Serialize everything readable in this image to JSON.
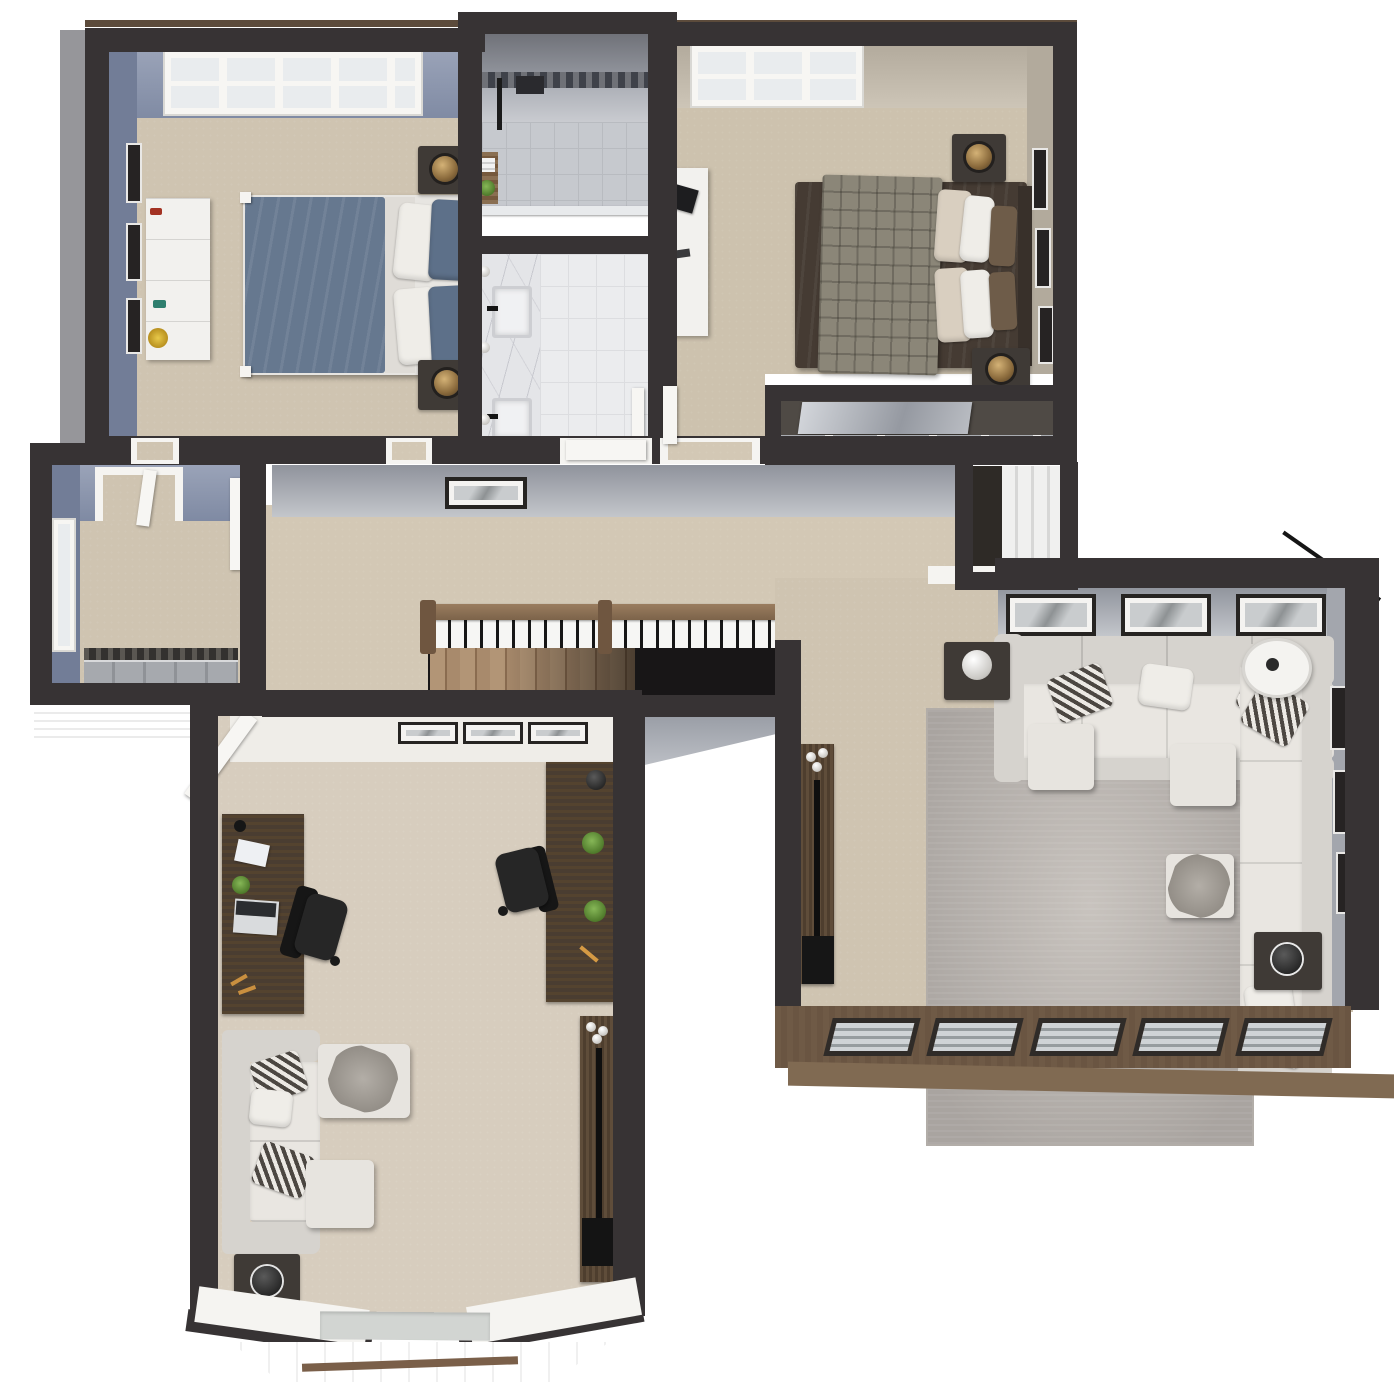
{
  "image_type": "3d-rendered-floor-plan-top-view",
  "visible_text": [],
  "palette": {
    "bg": "#ffffff",
    "wall": "#373334",
    "wall-outer-gray": "#96969a",
    "carpet": "#cfc4b1",
    "carpet-light": "#d7cdbe",
    "carpet-hall": "#d3c8b5",
    "blue-wall": "#8b95ac",
    "greige-wall": "#c1b8ab",
    "white-trim": "#f5f4f1",
    "duvet-blue": "#66788f",
    "bed2-brown": "#453b33",
    "sofa-gray": "#e7e4df",
    "rug-gray": "#bcb7b2",
    "desk-wood": "#4a3d31",
    "table-dark": "#3f3a36",
    "plant-green": "#4f7a2b",
    "ext-brown": "#6a5542",
    "void": "#181617",
    "wood-rail": "#8b7056",
    "tile-floor": "#ebecee"
  },
  "scene": {
    "floor_label": "upper-floor-plan",
    "rooms": [
      {
        "id": "bedroom-1",
        "position": "top-left",
        "wall_finish": "blue-gray",
        "furniture": [
          "tri-pane-window",
          "white-dresser-with-decor",
          "three-wall-frames",
          "queen-bed-blue-duvet-white-sheets",
          "two-nightstands-with-gold-lamps",
          "two-door-openings"
        ]
      },
      {
        "id": "bathroom",
        "position": "top-center",
        "wall_finish": "gray-tile",
        "furniture": [
          "walk-in-shower-mosaic-band",
          "black-shower-fixture",
          "wood-shelf-with-plant-and-towels",
          "marble-double-sink-vanity",
          "chrome-sconces",
          "tile-floor",
          "open-white-door",
          "towel-hooks"
        ]
      },
      {
        "id": "bedroom-2",
        "position": "top-right",
        "wall_finish": "greige",
        "furniture": [
          "tri-pane-window",
          "white-desk-with-laptop",
          "queen-bed-brown-duvet-plaid-throw",
          "cream-and-white-pillows",
          "two-nightstands-with-gold-lamps",
          "three-wall-frames",
          "sliding-mirror-closet",
          "open-white-door"
        ]
      },
      {
        "id": "walk-in-closet",
        "position": "mid-left",
        "wall_finish": "blue-gray",
        "furniture": [
          "side-window",
          "sliding-door-closet-with-clothes",
          "open-white-door"
        ]
      },
      {
        "id": "hallway",
        "position": "center",
        "wall_finish": "gray",
        "furniture": [
          "wall-art-frame",
          "wood-stair-railing-black-balusters",
          "staircase-going-down",
          "attic-stair-nook",
          "three-door-openings"
        ]
      },
      {
        "id": "living-room",
        "position": "right",
        "wall_finish": "gray",
        "furniture": [
          "three-wall-frames-top",
          "sectional-sofa-top",
          "sofa-right",
          "three-ottomans",
          "throw-blanket",
          "large-gray-area-rug",
          "end-table-with-sphere-lamp",
          "arc-floor-lamp",
          "end-table-with-black-lamp",
          "three-wall-frames-right",
          "wall-mounted-gym-board",
          "five-louver-windows-brown-wall"
        ]
      },
      {
        "id": "office-den",
        "position": "bottom-left",
        "wall_finish": "greige",
        "furniture": [
          "open-white-door",
          "three-wall-frames-top",
          "dark-desk-left-with-laptop-plant-notebook",
          "black-office-chair-left",
          "dark-desk-right-with-plants",
          "black-office-chair-right",
          "gray-sofa-striped-pillows",
          "chaise-with-throw-blanket",
          "ottoman",
          "side-table-with-black-lamp",
          "three-wall-frames-left",
          "wall-mounted-gym-board",
          "angled-bay-window-with-seat"
        ]
      }
    ]
  }
}
